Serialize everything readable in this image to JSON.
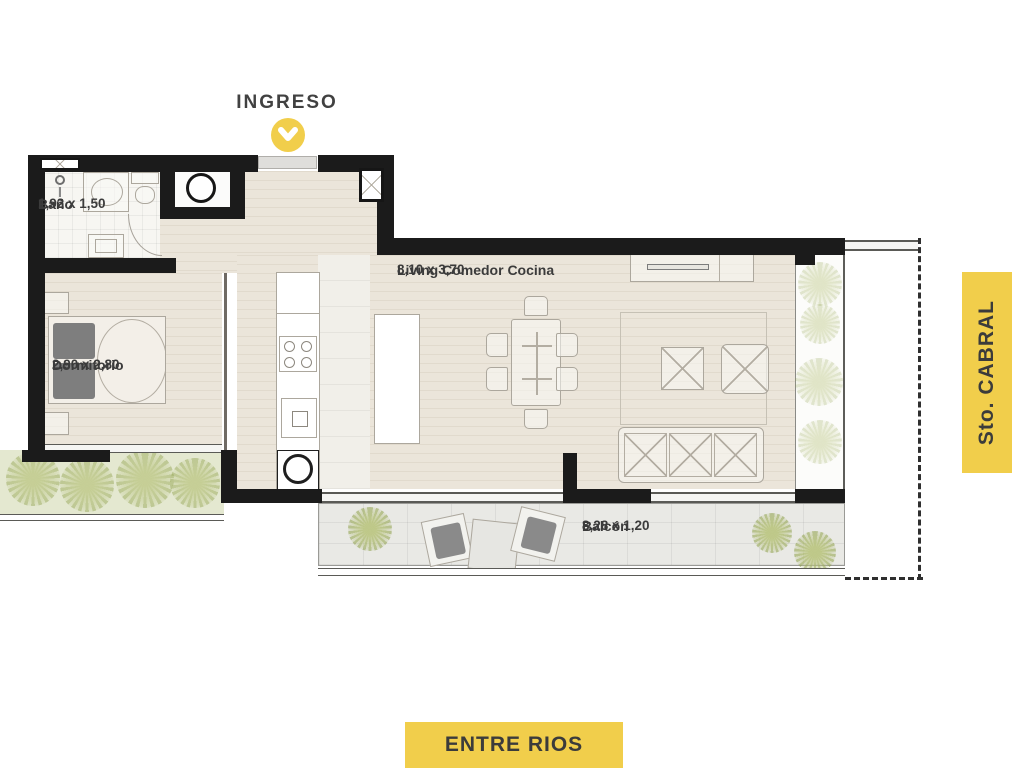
{
  "entrance": {
    "label": "INGRESO",
    "marker_icon": "chevron-down"
  },
  "rooms": {
    "bano": {
      "name": "Baño",
      "dims": "1,92 x 1,50"
    },
    "dormitorio": {
      "name": "Dormitorio",
      "dims": "2,90 x 2,80"
    },
    "living": {
      "name": "Living Comedor Cocina",
      "dims": "8,10 x 3,70"
    },
    "balcon": {
      "name": "Balcón",
      "dims": "8,28 x 1,20"
    }
  },
  "streets": {
    "right_vertical": "Sto. CABRAL",
    "bottom": "ENTRE RIOS"
  },
  "colors": {
    "accent_yellow": "#f1ce4b",
    "wall_black": "#1b1b1b",
    "label_text": "#3b3b3b",
    "garden_green": "#e4e8d0"
  }
}
